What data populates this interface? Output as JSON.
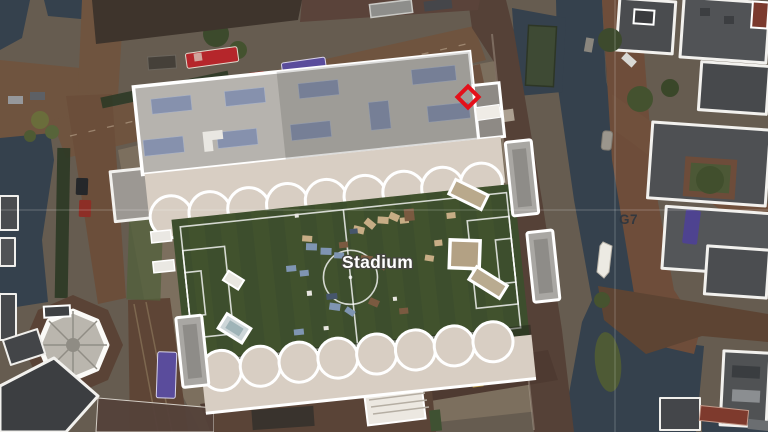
{
  "map": {
    "view": "aerial-satellite-city-map",
    "labels": {
      "stadium": "Stadium",
      "grid_cell": "G7"
    },
    "marker": {
      "name": "diamond-waypoint",
      "shape": "diamond-outline",
      "color": "#e4101a"
    },
    "grid": {
      "line_color": "rgba(255,255,255,0.20)"
    },
    "palette": {
      "water": "#35414d",
      "pitch_green": "#3d4e2d",
      "pitch_stripe": "#48592f",
      "stadium_roof": "#b6b3ae",
      "canopy_beige": "#d8cec3",
      "skylight_blue": "#8691ad",
      "road_brown": "#6f543f",
      "road_dark": "#554137",
      "building_gray": "#4a4c4f",
      "outline_white": "#ffffff",
      "bus_red": "#b5262b",
      "bus_purple": "#5a4c9c"
    }
  }
}
